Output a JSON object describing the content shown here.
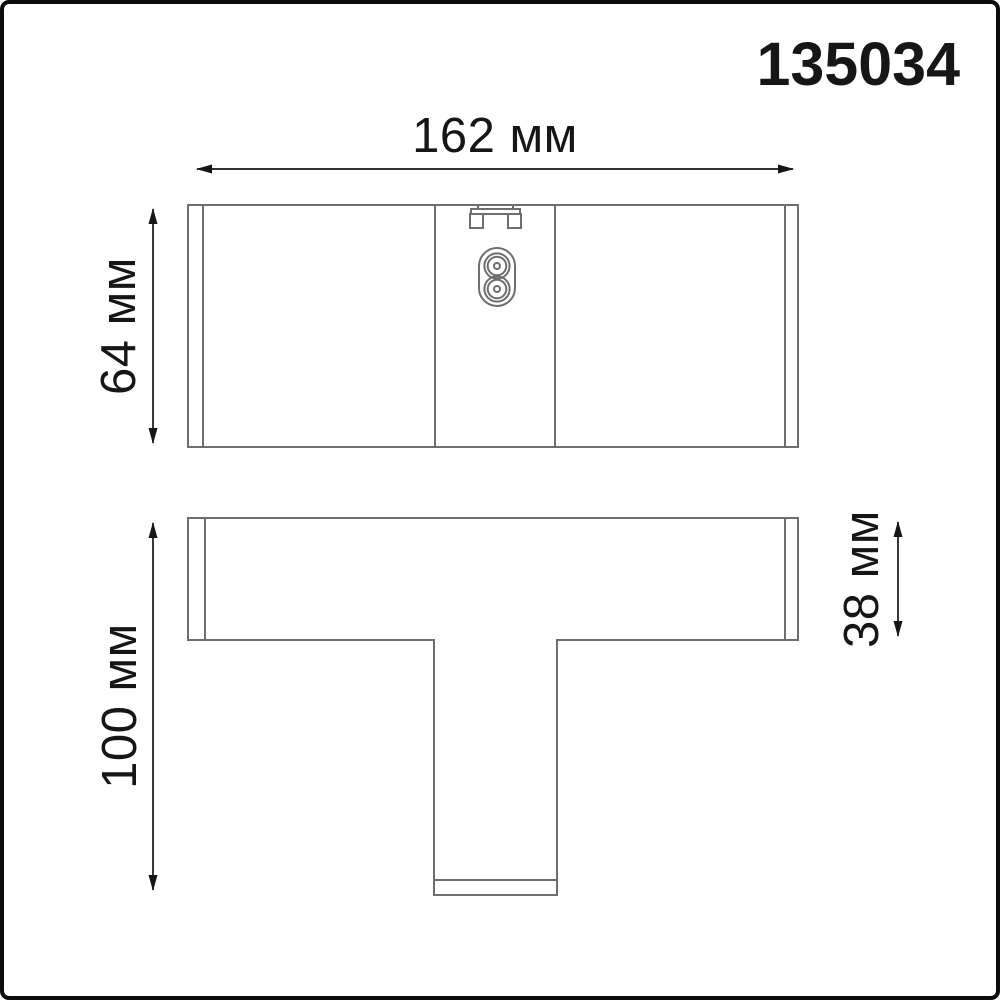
{
  "page": {
    "background": "#ffffff",
    "frame_border_color": "#0c0c0c"
  },
  "colors": {
    "part_outline": "#6e6e6e",
    "dimension_line": "#161616",
    "text": "#161616"
  },
  "title": {
    "text": "135034"
  },
  "dimensions": [
    {
      "id": "overall-width",
      "label": "162 мм",
      "value": 162,
      "unit": "мм",
      "orientation": "horizontal",
      "applies_to": "top-view"
    },
    {
      "id": "overall-height",
      "label": "64 мм",
      "value": 64,
      "unit": "мм",
      "orientation": "vertical",
      "applies_to": "top-view"
    },
    {
      "id": "overall-depth",
      "label": "100 мм",
      "value": 100,
      "unit": "мм",
      "orientation": "vertical",
      "applies_to": "bottom-view"
    },
    {
      "id": "bar-depth",
      "label": "38 мм",
      "value": 38,
      "unit": "мм",
      "orientation": "vertical",
      "applies_to": "bottom-view"
    }
  ],
  "icons": {
    "connector": "figure8-power-connector-icon",
    "clip": "mounting-clip-icon"
  }
}
